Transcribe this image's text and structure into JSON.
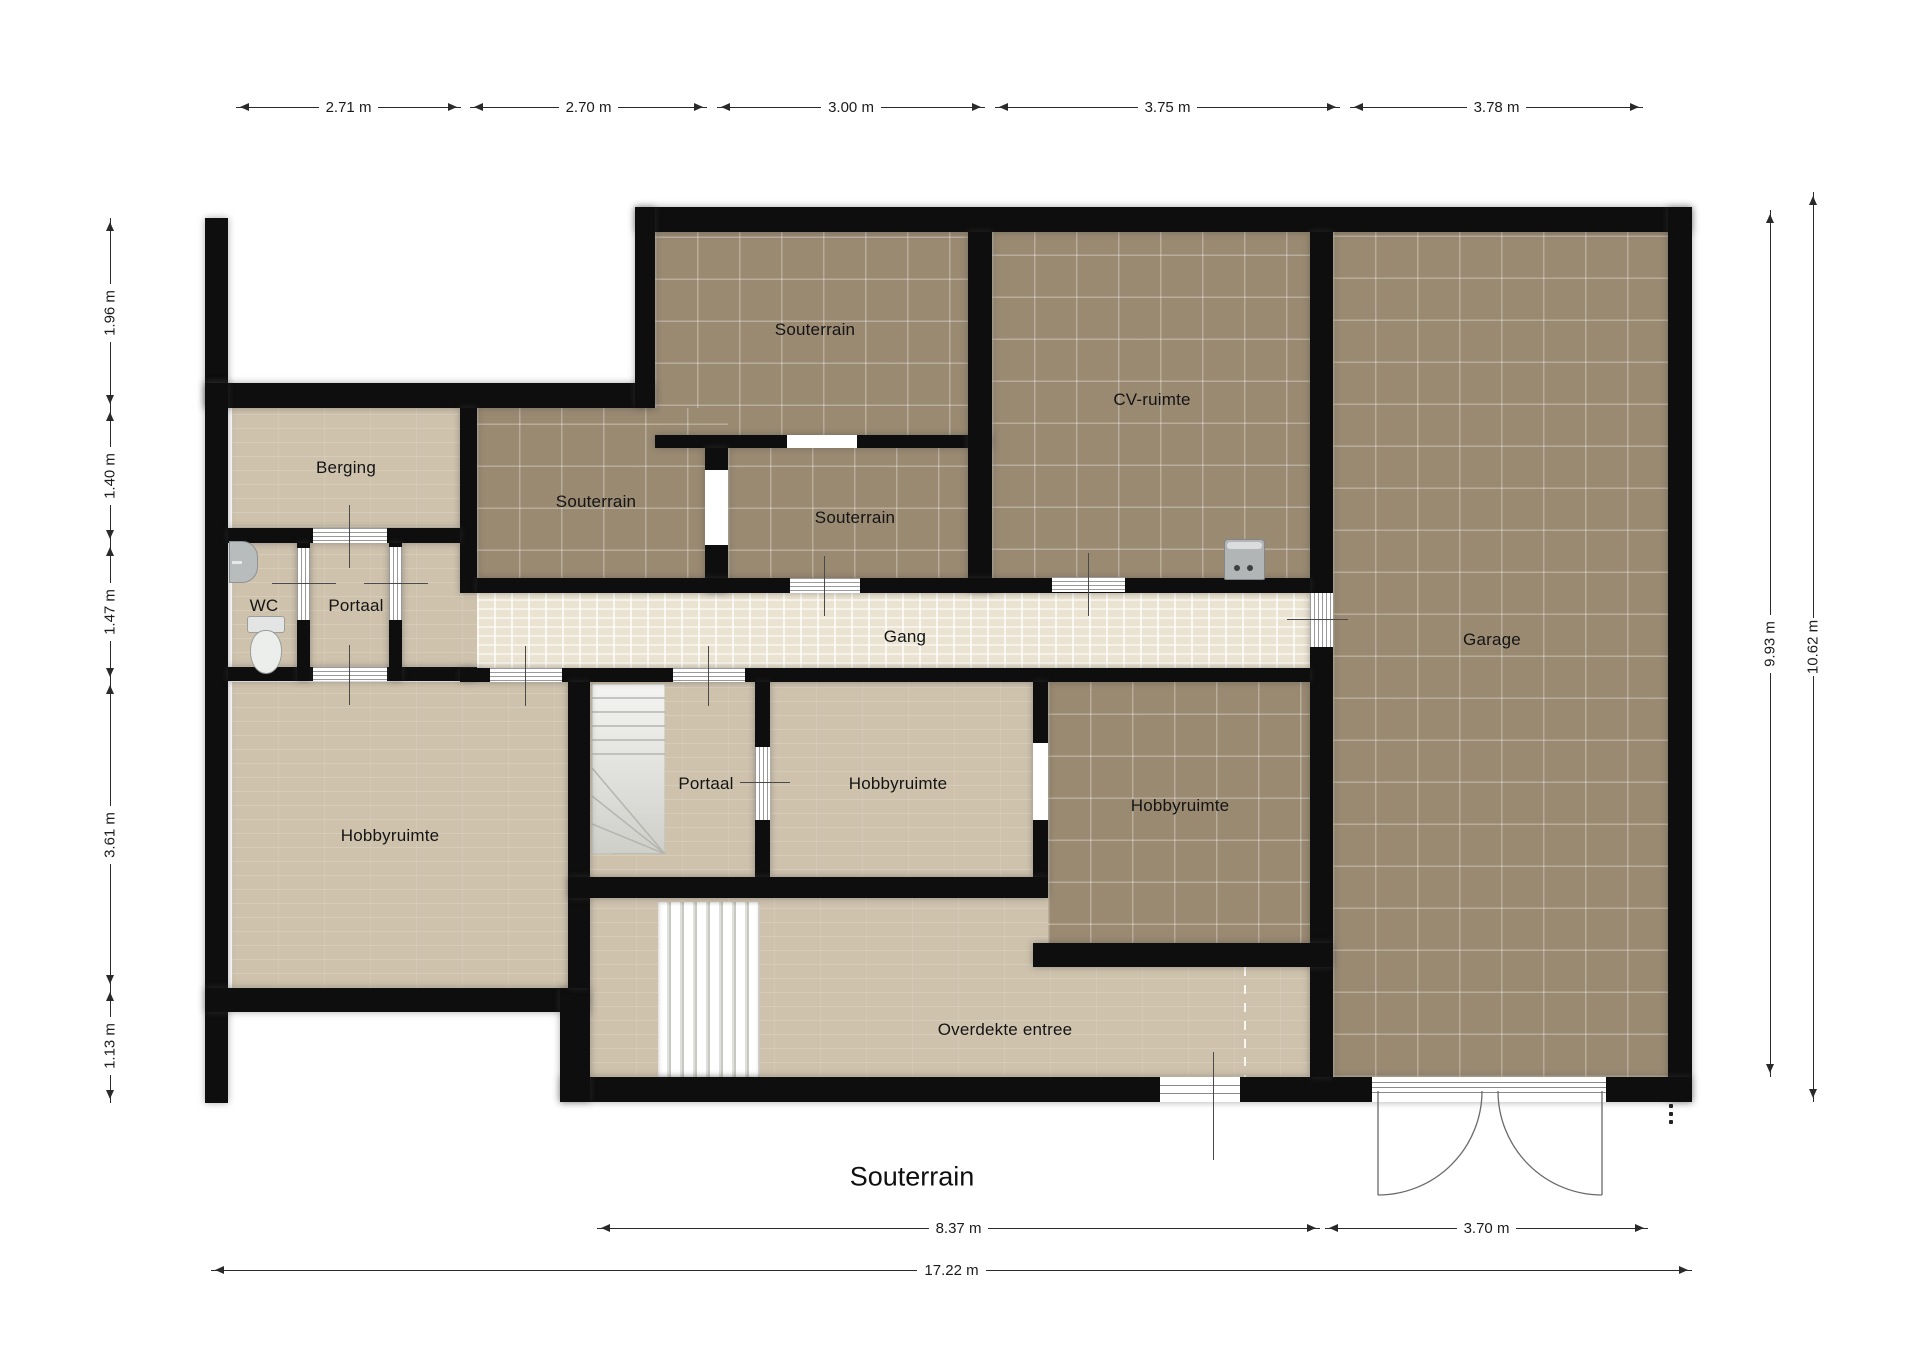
{
  "plan": {
    "title": "Souterrain"
  },
  "rooms": {
    "souterrain_top": {
      "label": "Souterrain"
    },
    "cv_ruimte": {
      "label": "CV-ruimte"
    },
    "garage": {
      "label": "Garage"
    },
    "berging": {
      "label": "Berging"
    },
    "souterrain_links": {
      "label": "Souterrain"
    },
    "souterrain_midden": {
      "label": "Souterrain"
    },
    "wc": {
      "label": "WC"
    },
    "portaal_boven": {
      "label": "Portaal"
    },
    "gang": {
      "label": "Gang"
    },
    "hobbyruimte_links": {
      "label": "Hobbyruimte"
    },
    "portaal_midden": {
      "label": "Portaal"
    },
    "hobbyruimte_midden": {
      "label": "Hobbyruimte"
    },
    "hobbyruimte_rechts": {
      "label": "Hobbyruimte"
    },
    "overdekte_entree": {
      "label": "Overdekte entree"
    }
  },
  "dims": {
    "top": [
      "2.71 m",
      "2.70 m",
      "3.00 m",
      "3.75 m",
      "3.78 m"
    ],
    "left": [
      "1.96 m",
      "1.40 m",
      "1.47 m",
      "3.61 m",
      "1.13 m"
    ],
    "right": [
      "9.93 m",
      "10.62 m"
    ],
    "bottom": [
      "8.37 m",
      "3.70 m",
      "17.22 m"
    ]
  },
  "colors": {
    "wall": "#0e0e0e",
    "floor_light": "#cec2ad",
    "floor_dark": "#9a8a72",
    "floor_gang": "#ebe3d1",
    "page": "#ffffff"
  },
  "icons": {
    "toilet": "toilet-icon",
    "washbasin": "washbasin-icon",
    "boiler": "cv-boiler-icon",
    "stairs_winder": "winder-stairs-icon",
    "stairs_straight": "straight-stairs-icon",
    "garage_doors": "garage-double-door-icon",
    "overflow_dots": "vertical-ellipsis-icon"
  }
}
